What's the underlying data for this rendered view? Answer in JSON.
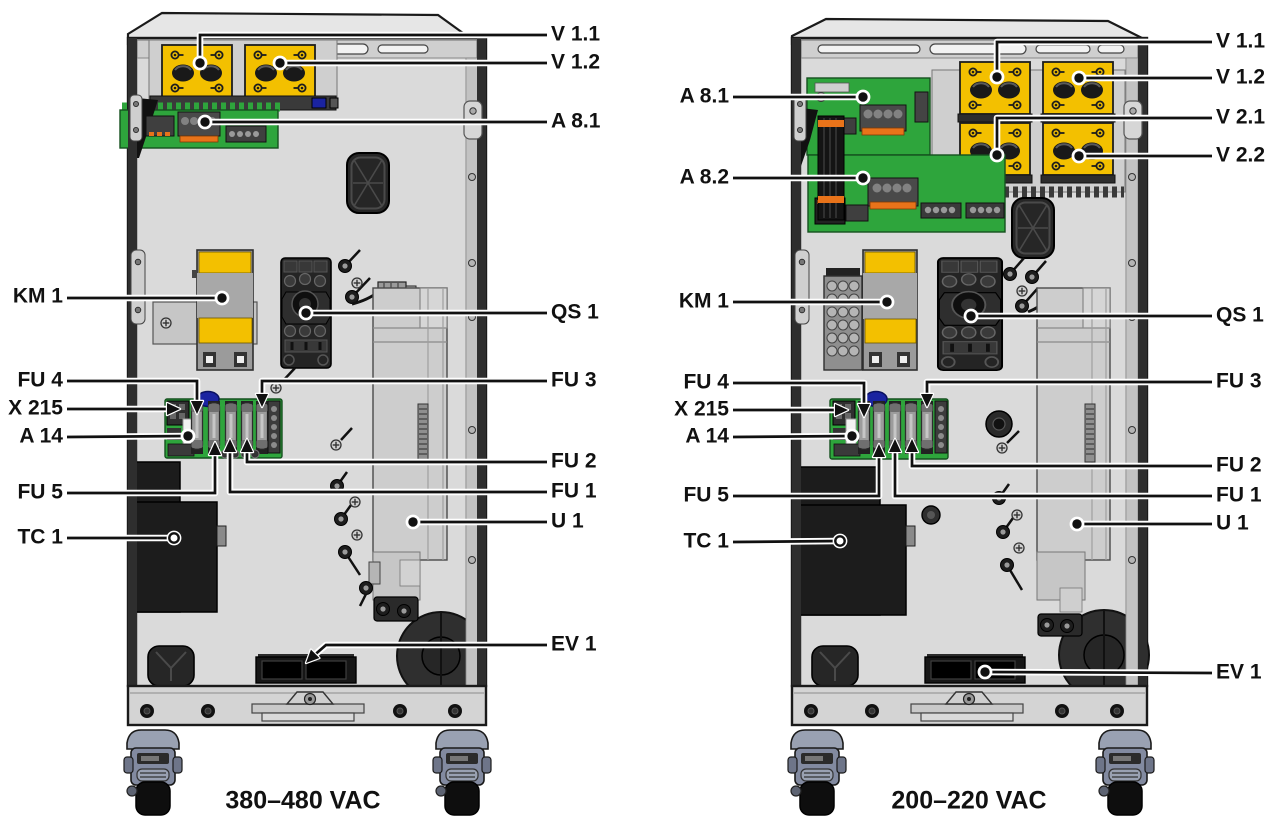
{
  "figure": {
    "type": "equipment-layout-diagram",
    "description_visible_text_only": true
  },
  "colors": {
    "module_yellow": "#F3C000",
    "pcb_green": "#2EA53C",
    "blue_component": "#1A23A0",
    "orange_connector": "#E8731A",
    "caster_slate": "#99A1B2",
    "cabinet_gray": "#D9D9D9",
    "line": "#111111"
  },
  "cabinets": [
    {
      "id": "left",
      "caption": "380–480 VAC",
      "callouts": [
        {
          "label": "V 1.1",
          "side": "right",
          "tx": 551,
          "ty": 35,
          "points": [
            [
              547,
              35
            ],
            [
              200,
              35
            ],
            [
              200,
              60
            ]
          ],
          "end": {
            "type": "dot",
            "x": 200,
            "y": 63
          }
        },
        {
          "label": "V 1.2",
          "side": "right",
          "tx": 551,
          "ty": 63,
          "points": [
            [
              547,
              63
            ],
            [
              280,
              63
            ]
          ],
          "end": {
            "type": "dot",
            "x": 280,
            "y": 63
          }
        },
        {
          "label": "A 8.1",
          "side": "right",
          "tx": 551,
          "ty": 122,
          "points": [
            [
              547,
              122
            ],
            [
              205,
              122
            ]
          ],
          "end": {
            "type": "dot",
            "x": 205,
            "y": 122
          }
        },
        {
          "label": "QS 1",
          "side": "right",
          "tx": 551,
          "ty": 313,
          "points": [
            [
              547,
              313
            ],
            [
              306,
              313
            ]
          ],
          "end": {
            "type": "dot",
            "x": 306,
            "y": 313
          }
        },
        {
          "label": "FU 3",
          "side": "right",
          "tx": 551,
          "ty": 381,
          "points": [
            [
              547,
              381
            ],
            [
              262,
              381
            ],
            [
              262,
              400
            ]
          ],
          "end": {
            "type": "arrow",
            "x": 262,
            "y": 407,
            "angle": 90
          }
        },
        {
          "label": "FU 2",
          "side": "right",
          "tx": 551,
          "ty": 462,
          "points": [
            [
              547,
              462
            ],
            [
              247,
              462
            ],
            [
              247,
              446
            ]
          ],
          "end": {
            "type": "arrow",
            "x": 247,
            "y": 439,
            "angle": 270
          }
        },
        {
          "label": "FU 1",
          "side": "right",
          "tx": 551,
          "ty": 492,
          "points": [
            [
              547,
              492
            ],
            [
              230,
              492
            ],
            [
              230,
              446
            ]
          ],
          "end": {
            "type": "arrow",
            "x": 230,
            "y": 439,
            "angle": 270
          }
        },
        {
          "label": "U 1",
          "side": "right",
          "tx": 551,
          "ty": 522,
          "points": [
            [
              547,
              522
            ],
            [
              413,
              522
            ]
          ],
          "end": {
            "type": "dot",
            "x": 413,
            "y": 522
          }
        },
        {
          "label": "EV 1",
          "side": "right",
          "tx": 551,
          "ty": 645,
          "points": [
            [
              547,
              645
            ],
            [
              326,
              645
            ],
            [
              311,
              658
            ]
          ],
          "end": {
            "type": "arrow",
            "x": 306,
            "y": 663,
            "angle": 135
          }
        },
        {
          "label": "KM 1",
          "side": "left",
          "tx": 63,
          "ty": 297,
          "points": [
            [
              67,
              298
            ],
            [
              222,
              298
            ]
          ],
          "end": {
            "type": "dot",
            "x": 222,
            "y": 298
          }
        },
        {
          "label": "FU 4",
          "side": "left",
          "tx": 63,
          "ty": 381,
          "points": [
            [
              67,
              381
            ],
            [
              197,
              381
            ],
            [
              197,
              407
            ]
          ],
          "end": {
            "type": "arrow",
            "x": 197,
            "y": 414,
            "angle": 90
          }
        },
        {
          "label": "X 215",
          "side": "left",
          "tx": 63,
          "ty": 409,
          "points": [
            [
              67,
              409
            ],
            [
              172,
              409
            ]
          ],
          "end": {
            "type": "arrow",
            "x": 180,
            "y": 409,
            "angle": 0
          }
        },
        {
          "label": "A 14",
          "side": "left",
          "tx": 63,
          "ty": 437,
          "points": [
            [
              67,
              437
            ],
            [
              188,
              436
            ]
          ],
          "end": {
            "type": "dot",
            "x": 188,
            "y": 436
          }
        },
        {
          "label": "FU 5",
          "side": "left",
          "tx": 63,
          "ty": 493,
          "points": [
            [
              67,
              493
            ],
            [
              215,
              493
            ],
            [
              215,
              449
            ]
          ],
          "end": {
            "type": "arrow",
            "x": 215,
            "y": 442,
            "angle": 270
          }
        },
        {
          "label": "TC 1",
          "side": "left",
          "tx": 63,
          "ty": 538,
          "points": [
            [
              67,
              538
            ],
            [
              174,
              538
            ]
          ],
          "end": {
            "type": "open-dot",
            "x": 174,
            "y": 538
          }
        }
      ]
    },
    {
      "id": "right",
      "caption": "200–220 VAC",
      "callouts": [
        {
          "label": "V 1.1",
          "side": "right",
          "tx": 1216,
          "ty": 42,
          "points": [
            [
              1212,
              42
            ],
            [
              997,
              42
            ],
            [
              997,
              73
            ]
          ],
          "end": {
            "type": "dot",
            "x": 997,
            "y": 77
          }
        },
        {
          "label": "V 1.2",
          "side": "right",
          "tx": 1216,
          "ty": 78,
          "points": [
            [
              1212,
              78
            ],
            [
              1079,
              78
            ]
          ],
          "end": {
            "type": "dot",
            "x": 1079,
            "y": 78
          }
        },
        {
          "label": "V 2.1",
          "side": "right",
          "tx": 1216,
          "ty": 118,
          "points": [
            [
              1212,
              118
            ],
            [
              997,
              118
            ],
            [
              997,
              150
            ]
          ],
          "end": {
            "type": "dot",
            "x": 997,
            "y": 155
          }
        },
        {
          "label": "V 2.2",
          "side": "right",
          "tx": 1216,
          "ty": 156,
          "points": [
            [
              1212,
              156
            ],
            [
              1079,
              156
            ]
          ],
          "end": {
            "type": "dot",
            "x": 1079,
            "y": 156
          }
        },
        {
          "label": "QS 1",
          "side": "right",
          "tx": 1216,
          "ty": 316,
          "points": [
            [
              1212,
              316
            ],
            [
              971,
              316
            ]
          ],
          "end": {
            "type": "dot",
            "x": 971,
            "y": 316
          }
        },
        {
          "label": "FU 3",
          "side": "right",
          "tx": 1216,
          "ty": 382,
          "points": [
            [
              1212,
              382
            ],
            [
              927,
              382
            ],
            [
              927,
              400
            ]
          ],
          "end": {
            "type": "arrow",
            "x": 927,
            "y": 407,
            "angle": 90
          }
        },
        {
          "label": "FU 2",
          "side": "right",
          "tx": 1216,
          "ty": 466,
          "points": [
            [
              1212,
              466
            ],
            [
              912,
              466
            ],
            [
              912,
              446
            ]
          ],
          "end": {
            "type": "arrow",
            "x": 912,
            "y": 439,
            "angle": 270
          }
        },
        {
          "label": "FU 1",
          "side": "right",
          "tx": 1216,
          "ty": 496,
          "points": [
            [
              1212,
              496
            ],
            [
              895,
              496
            ],
            [
              895,
              446
            ]
          ],
          "end": {
            "type": "arrow",
            "x": 895,
            "y": 439,
            "angle": 270
          }
        },
        {
          "label": "U 1",
          "side": "right",
          "tx": 1216,
          "ty": 524,
          "points": [
            [
              1212,
              524
            ],
            [
              1077,
              524
            ]
          ],
          "end": {
            "type": "dot",
            "x": 1077,
            "y": 524
          }
        },
        {
          "label": "EV 1",
          "side": "right",
          "tx": 1216,
          "ty": 673,
          "points": [
            [
              1212,
              673
            ],
            [
              985,
              672
            ]
          ],
          "end": {
            "type": "dot",
            "x": 985,
            "y": 672
          }
        },
        {
          "label": "A 8.1",
          "side": "left",
          "tx": 729,
          "ty": 97,
          "points": [
            [
              733,
              97
            ],
            [
              863,
              97
            ]
          ],
          "end": {
            "type": "dot",
            "x": 863,
            "y": 97
          }
        },
        {
          "label": "A 8.2",
          "side": "left",
          "tx": 729,
          "ty": 178,
          "points": [
            [
              733,
              178
            ],
            [
              863,
              178
            ]
          ],
          "end": {
            "type": "dot",
            "x": 863,
            "y": 178
          }
        },
        {
          "label": "KM 1",
          "side": "left",
          "tx": 729,
          "ty": 302,
          "points": [
            [
              733,
              302
            ],
            [
              887,
              302
            ]
          ],
          "end": {
            "type": "dot",
            "x": 887,
            "y": 302
          }
        },
        {
          "label": "FU 4",
          "side": "left",
          "tx": 729,
          "ty": 383,
          "points": [
            [
              733,
              383
            ],
            [
              864,
              383
            ],
            [
              864,
              410
            ]
          ],
          "end": {
            "type": "arrow",
            "x": 864,
            "y": 417,
            "angle": 90
          }
        },
        {
          "label": "X 215",
          "side": "left",
          "tx": 729,
          "ty": 410,
          "points": [
            [
              733,
              410
            ],
            [
              840,
              410
            ]
          ],
          "end": {
            "type": "arrow",
            "x": 848,
            "y": 410,
            "angle": 0
          }
        },
        {
          "label": "A 14",
          "side": "left",
          "tx": 729,
          "ty": 437,
          "points": [
            [
              733,
              437
            ],
            [
              852,
              436
            ]
          ],
          "end": {
            "type": "dot",
            "x": 852,
            "y": 436
          }
        },
        {
          "label": "FU 5",
          "side": "left",
          "tx": 729,
          "ty": 496,
          "points": [
            [
              733,
              496
            ],
            [
              879,
              496
            ],
            [
              879,
              451
            ]
          ],
          "end": {
            "type": "arrow",
            "x": 879,
            "y": 444,
            "angle": 270
          }
        },
        {
          "label": "TC 1",
          "side": "left",
          "tx": 729,
          "ty": 542,
          "points": [
            [
              733,
              542
            ],
            [
              840,
              541
            ]
          ],
          "end": {
            "type": "open-dot",
            "x": 840,
            "y": 541
          }
        }
      ]
    }
  ]
}
